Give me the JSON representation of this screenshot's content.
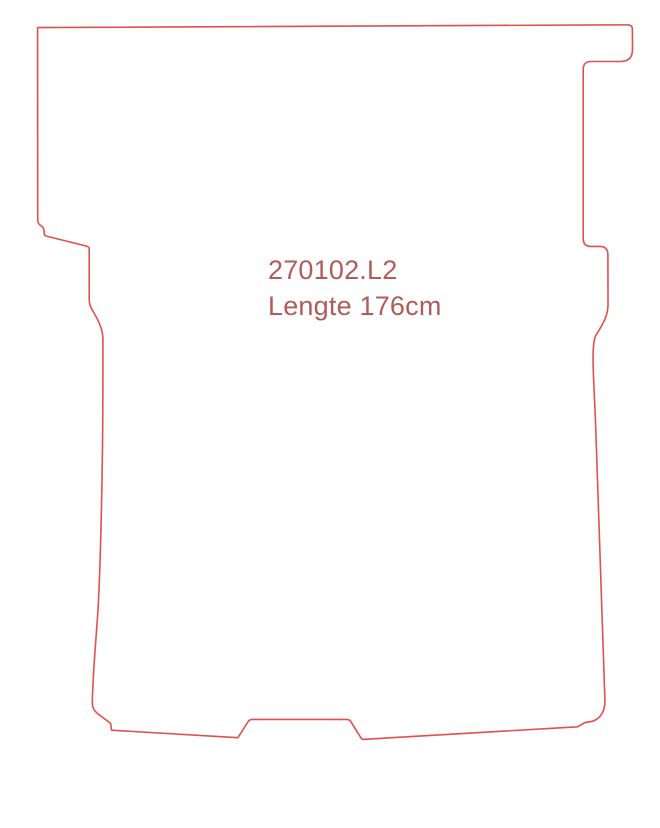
{
  "drawing": {
    "type": "cutting-template-outline",
    "viewbox": "0 0 660 828",
    "outline_path": "M 37.6 27.6 L 627 24.8 Q 632.4 24.6 632.4 29.6 L 632.5 49.5 Q 632.5 61.5 620.5 61.5 L 591 61.5 Q 583.2 61.5 583.2 69.5 L 583.2 238.5 Q 583.2 246.4 591 246.4 L 600 246.4 Q 607.9 246.6 607.9 254.5 L 608 304 C 608.3 317 601 327 595.5 336 C 590.8 347 594 380 595.8 430 C 597.5 490 602.5 620 604.9 700 C 605.3 711 600.5 718.8 592.3 721.3 L 585 722.6 L 577.5 726.8 L 363 739.4 L 361.3 738.4 L 350.8 721.6 Q 349.5 719.4 346.5 719.4 L 252.3 719.4 Q 249.5 719.4 248.2 721.5 L 237.9 737.7 L 111.6 730.2 L 110.6 723.4 L 97.2 713.2 Q 92.2 709.4 92.3 702.5 C 92.9 672 96 640 98 610 C 100.5 565 102.9 470 102.9 380 L 102.9 338.5 C 102.5 326 96 317 91.5 308.5 Q 89.2 304 89.2 299 L 89.2 249.5 Q 89.2 246.8 86.6 246.1 L 46.3 236.1 Q 44.3 235.5 44.2 233.4 L 44 230.6 Q 43.8 227.4 41 225.8 Q 37.7 223.8 37.7 219.9 Z",
    "stroke_width": "1.6"
  },
  "labels": {
    "part_number": "270102.L2",
    "length": "Lengte 176cm"
  },
  "colors": {
    "outline": "#e0504d",
    "label_text": "#b25b58",
    "background": "#ffffff"
  }
}
